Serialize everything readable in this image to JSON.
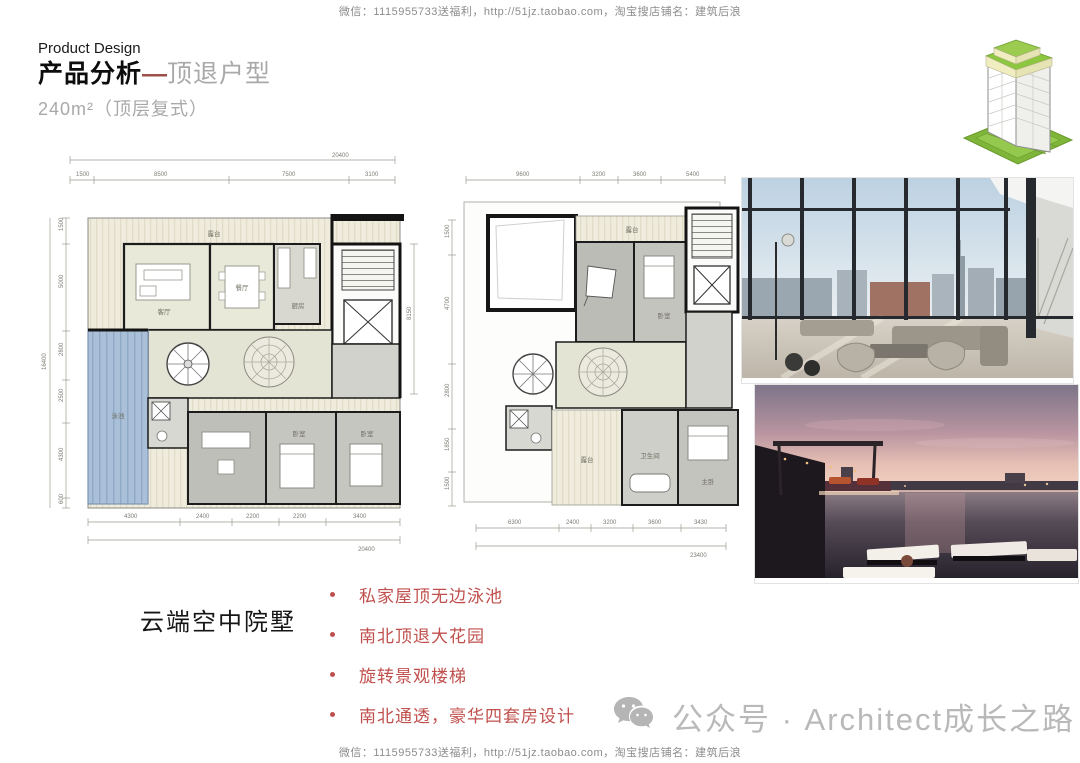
{
  "watermark": {
    "line": "微信：1115955733送福利，http://51jz.taobao.com，淘宝搜店铺名：建筑后浪",
    "brand": "公众号 · Architect成长之路"
  },
  "header": {
    "eyebrow": "Product Design",
    "title": "产品分析",
    "dash": "—",
    "title_sub": "顶退户型",
    "subtitle": "240m²（顶层复式）"
  },
  "tagline": "云端空中院墅",
  "features": [
    "私家屋顶无边泳池",
    "南北顶退大花园",
    "旋转景观楼梯",
    "南北通透，豪华四套房设计"
  ],
  "plans": {
    "left": {
      "dims_top_total": "20400",
      "dims_top": [
        "1500",
        "8500",
        "7500",
        "3100"
      ],
      "dims_left_total": "16400",
      "dims_left": [
        "1500",
        "5000",
        "2800",
        "2500",
        "4300",
        "600"
      ],
      "dims_right": "8150",
      "dims_bottom": [
        "4300",
        "2400",
        "2200",
        "2200",
        "3400"
      ],
      "dims_bottom_total": "20400",
      "labels": {
        "terrace": "露台",
        "living": "客厅",
        "dining": "餐厅",
        "kitchen": "厨房",
        "pool": "泳池",
        "bedroom_a": "卧室",
        "bedroom_b": "卧室"
      }
    },
    "right": {
      "dims_top": [
        "9600",
        "3200",
        "3600",
        "5400"
      ],
      "dims_left": [
        "1500",
        "4700",
        "2800",
        "1850",
        "1500"
      ],
      "dims_bottom": [
        "6300",
        "2400",
        "3200",
        "3600",
        "3430"
      ],
      "dims_bottom_total": "23400",
      "labels": {
        "terrace_top": "露台",
        "bedroom": "卧室",
        "bath": "卫生间",
        "terrace_bottom": "露台",
        "master": "主卧"
      }
    }
  },
  "colors": {
    "accent_red": "#c0504d",
    "title_gray": "#a9a9a9",
    "watermark_gray": "#8c8c8c",
    "brand_gray": "#b9b9b9",
    "pool_blue": "#a9c0d8",
    "plan_cream": "#efecdd",
    "icon_green": "#8dc63f"
  }
}
